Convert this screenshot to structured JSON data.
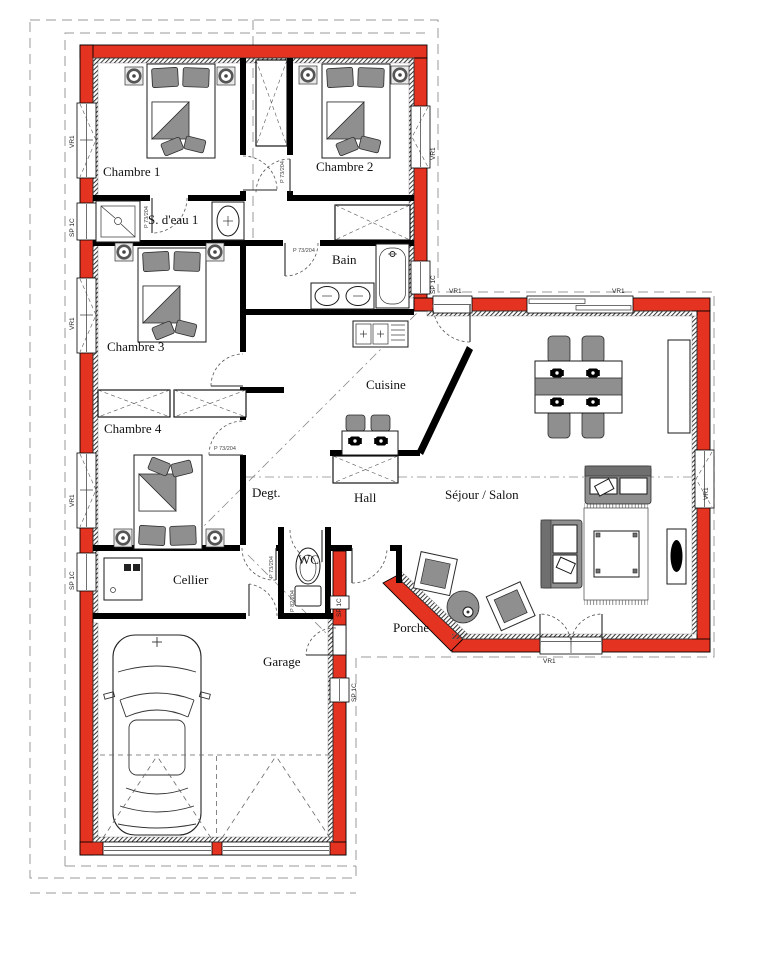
{
  "rooms": {
    "chambre1": "Chambre 1",
    "chambre2": "Chambre 2",
    "chambre3": "Chambre 3",
    "chambre4": "Chambre 4",
    "sdeau1": "S. d'eau 1",
    "bain": "Bain",
    "cuisine": "Cuisine",
    "hall": "Hall",
    "degt": "Degt.",
    "sejour": "Séjour / Salon",
    "cellier": "Cellier",
    "wc": "WC",
    "porche": "Porche",
    "garage": "Garage"
  },
  "windows": {
    "vr1": "VR1",
    "sp1c": "SP 1C"
  },
  "doors": {
    "p73": "P 73/204",
    "p82": "P 82/204"
  },
  "colors": {
    "exterior_wall": "#e53322",
    "interior_wall": "#000000",
    "furniture": "#8f8f8f",
    "furniture_dark": "#6f6f6f"
  }
}
